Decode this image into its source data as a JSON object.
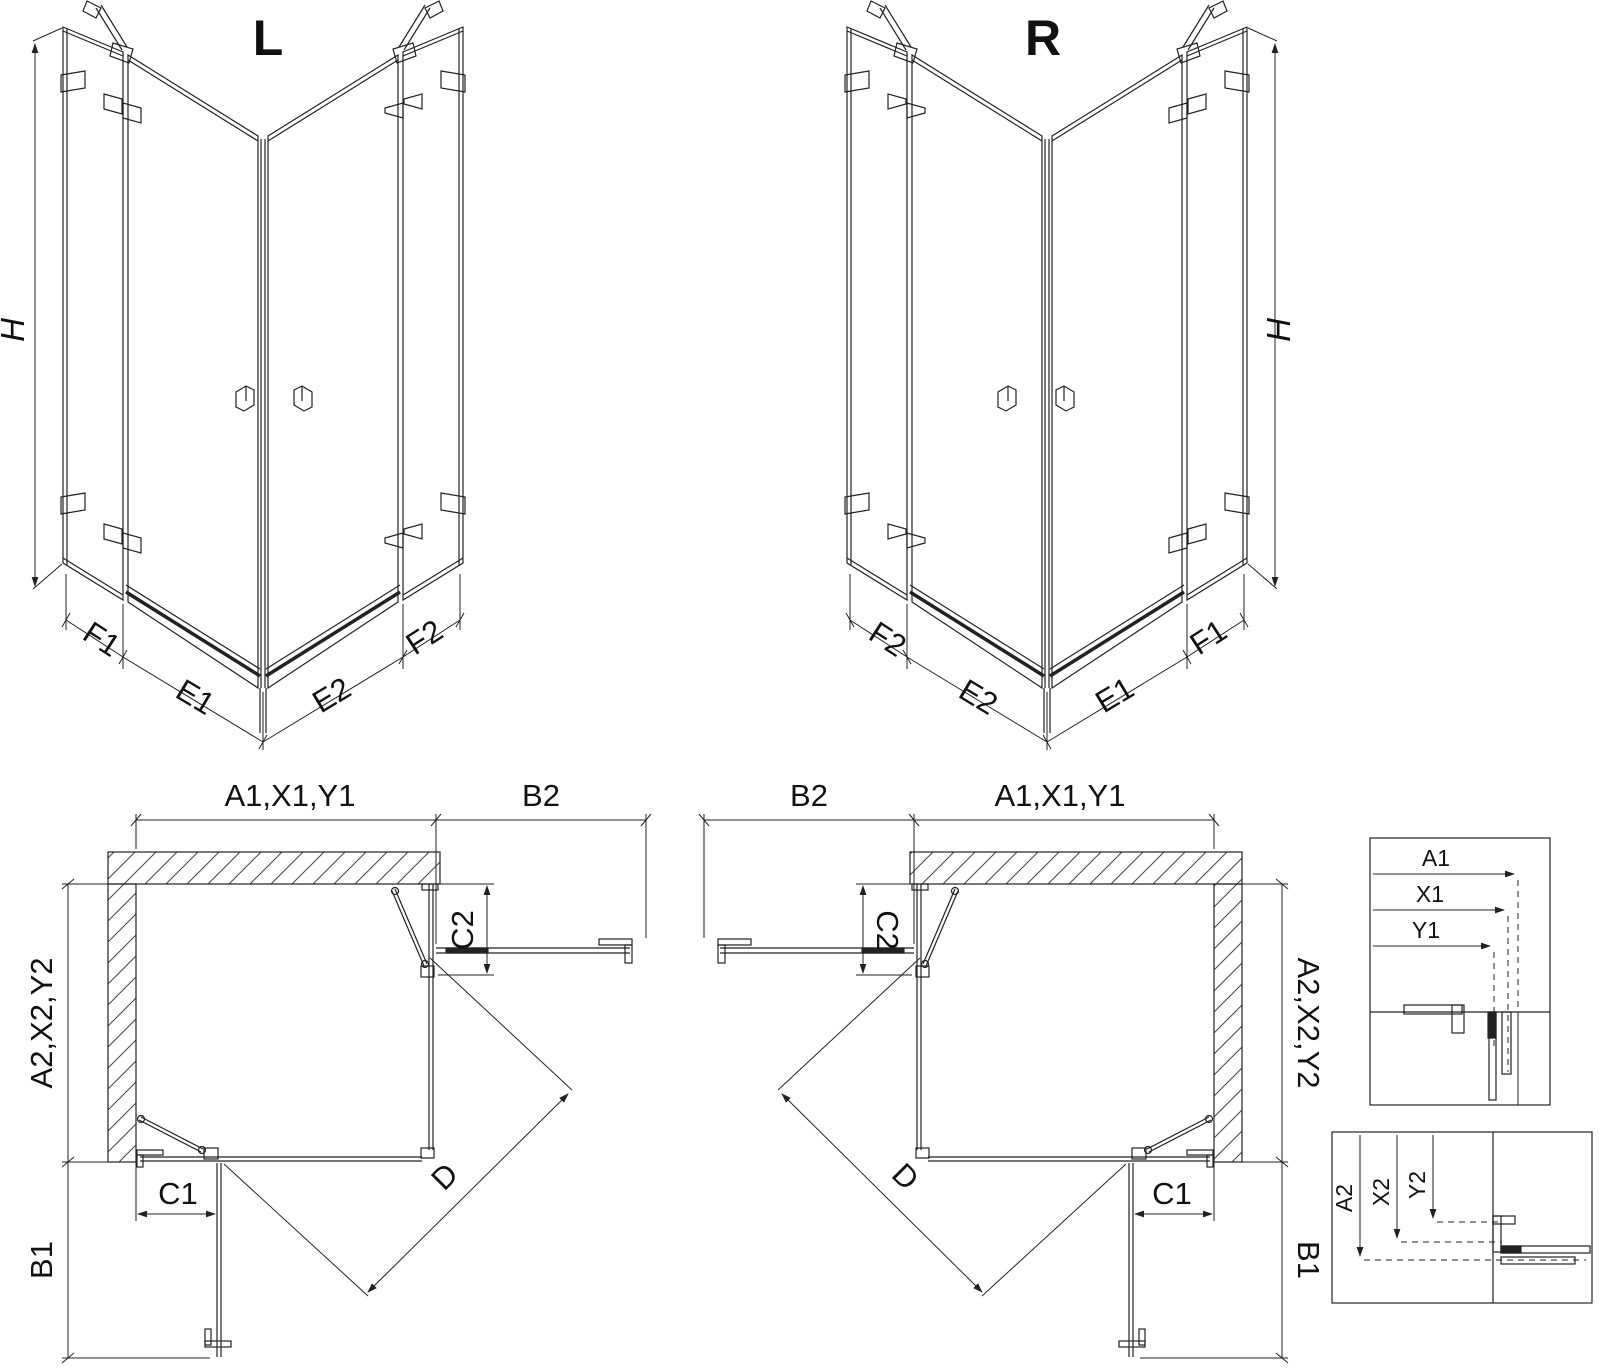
{
  "drawing": {
    "iso_left": {
      "title": "L",
      "height_label": "H",
      "bottom_segments": [
        "F1",
        "E1",
        "E2",
        "F2"
      ]
    },
    "iso_right": {
      "title": "R",
      "height_label": "H",
      "bottom_segments": [
        "F2",
        "E2",
        "E1",
        "F1"
      ]
    },
    "plan_left": {
      "top_width": "A1,X1,Y1",
      "return_width": "B2",
      "side_panel": "C2",
      "depth": "A2,X2,Y2",
      "front_panel": "C1",
      "return_depth": "B1",
      "diagonal": "D"
    },
    "plan_right": {
      "top_width": "A1,X1,Y1",
      "return_width": "B2",
      "side_panel": "C2",
      "depth": "A2,X2,Y2",
      "front_panel": "C1",
      "return_depth": "B1",
      "diagonal": "D"
    },
    "detail_width": {
      "labels": [
        "A1",
        "X1",
        "Y1"
      ]
    },
    "detail_depth": {
      "labels": [
        "A2",
        "X2",
        "Y2"
      ]
    }
  }
}
